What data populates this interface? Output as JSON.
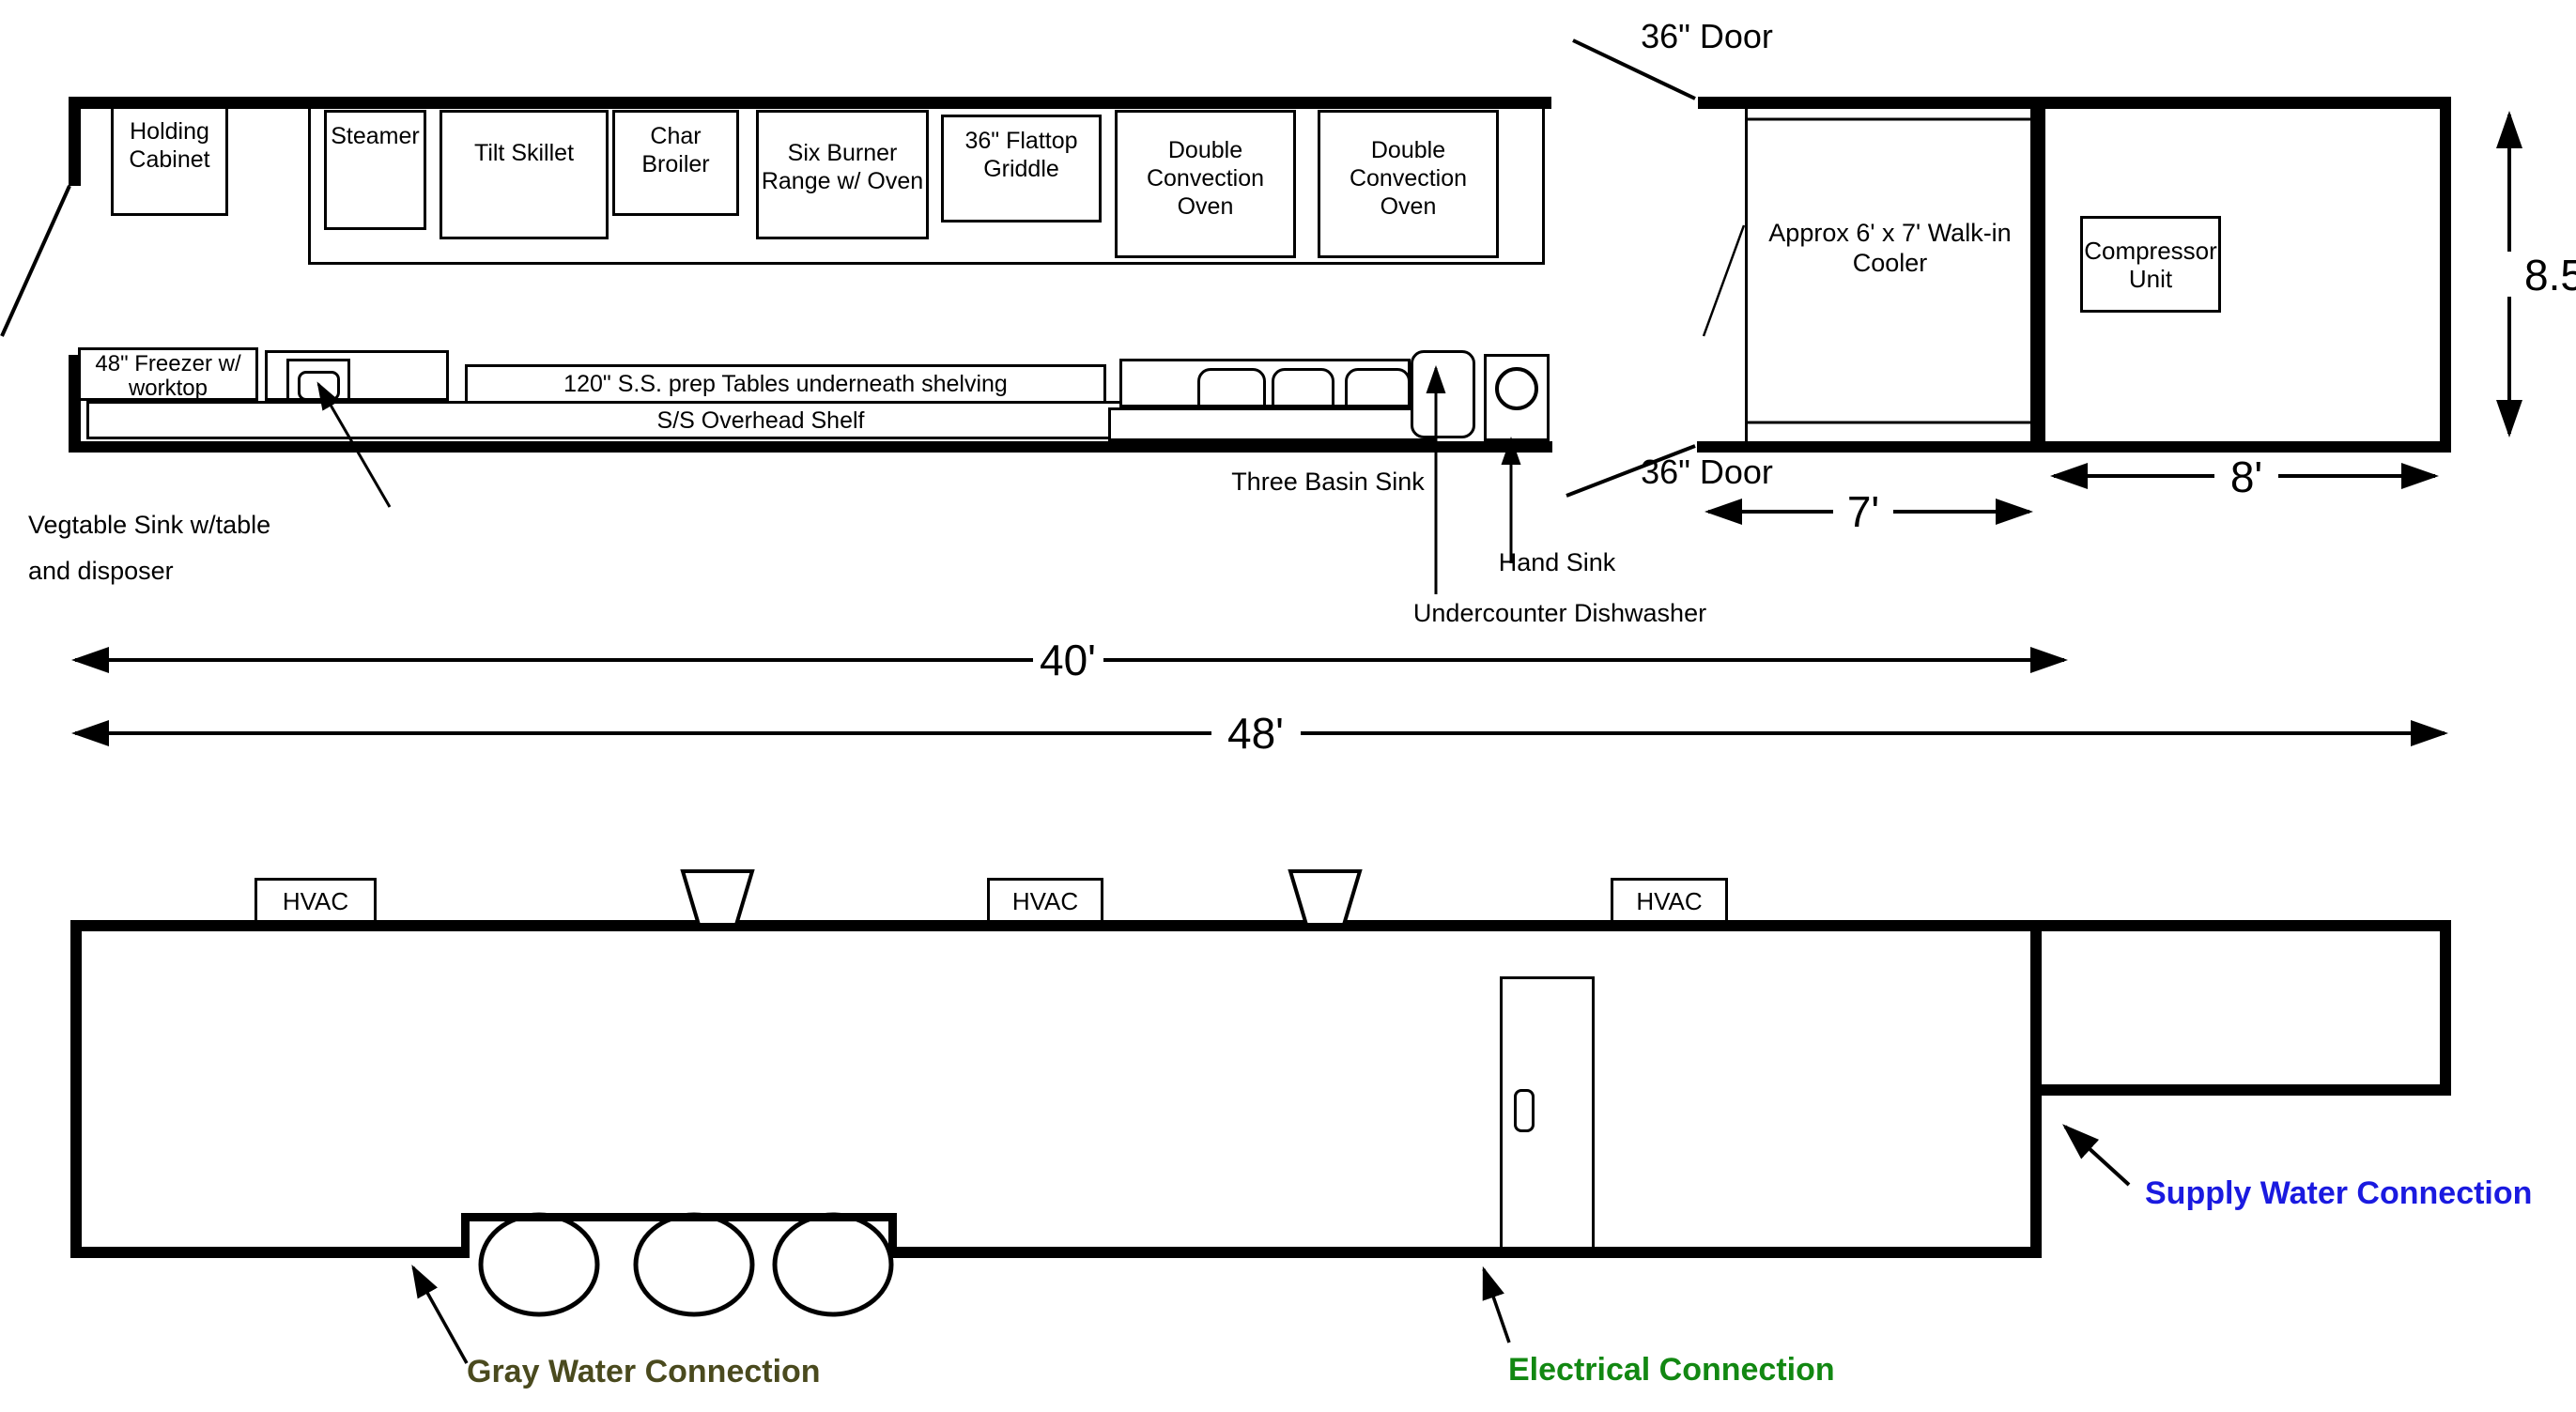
{
  "top_view": {
    "door_top": "36\" Door",
    "door_bottom": "36\" Door",
    "holding_cabinet": "Holding Cabinet",
    "steamer": "Steamer",
    "tilt_skillet": "Tilt Skillet",
    "char_broiler": "Char Broiler",
    "six_burner_range": "Six Burner Range w/ Oven",
    "flattop_griddle": "36\" Flattop Griddle",
    "convection_oven_1": "Double Convection Oven",
    "convection_oven_2": "Double Convection Oven",
    "freezer": "48\" Freezer w/ worktop",
    "prep_tables": "120\" S.S. prep Tables underneath shelving",
    "overhead_shelf": "S/S Overhead Shelf",
    "veg_sink_line1": "Vegtable Sink w/table",
    "veg_sink_line2": "and disposer",
    "three_basin_sink": "Three Basin Sink",
    "hand_sink": "Hand Sink",
    "undercounter_dishwasher": "Undercounter Dishwasher",
    "walk_in_cooler": "Approx 6' x 7' Walk-in Cooler",
    "compressor_unit": "Compressor Unit"
  },
  "dimensions": {
    "kitchen_length": "40'",
    "total_length": "48'",
    "cooler_width": "7'",
    "compressor_width": "8'",
    "trailer_height": "8.5'"
  },
  "bottom_view": {
    "hvac_1": "HVAC",
    "hvac_2": "HVAC",
    "hvac_3": "HVAC",
    "gray_water": "Gray Water Connection",
    "electrical": "Electrical Connection",
    "supply_water": "Supply Water Connection"
  },
  "colors": {
    "line": "#000000",
    "gray_water_label": "#4a4a1e",
    "electrical_label": "#128812",
    "supply_water_label": "#1a1ae0"
  }
}
